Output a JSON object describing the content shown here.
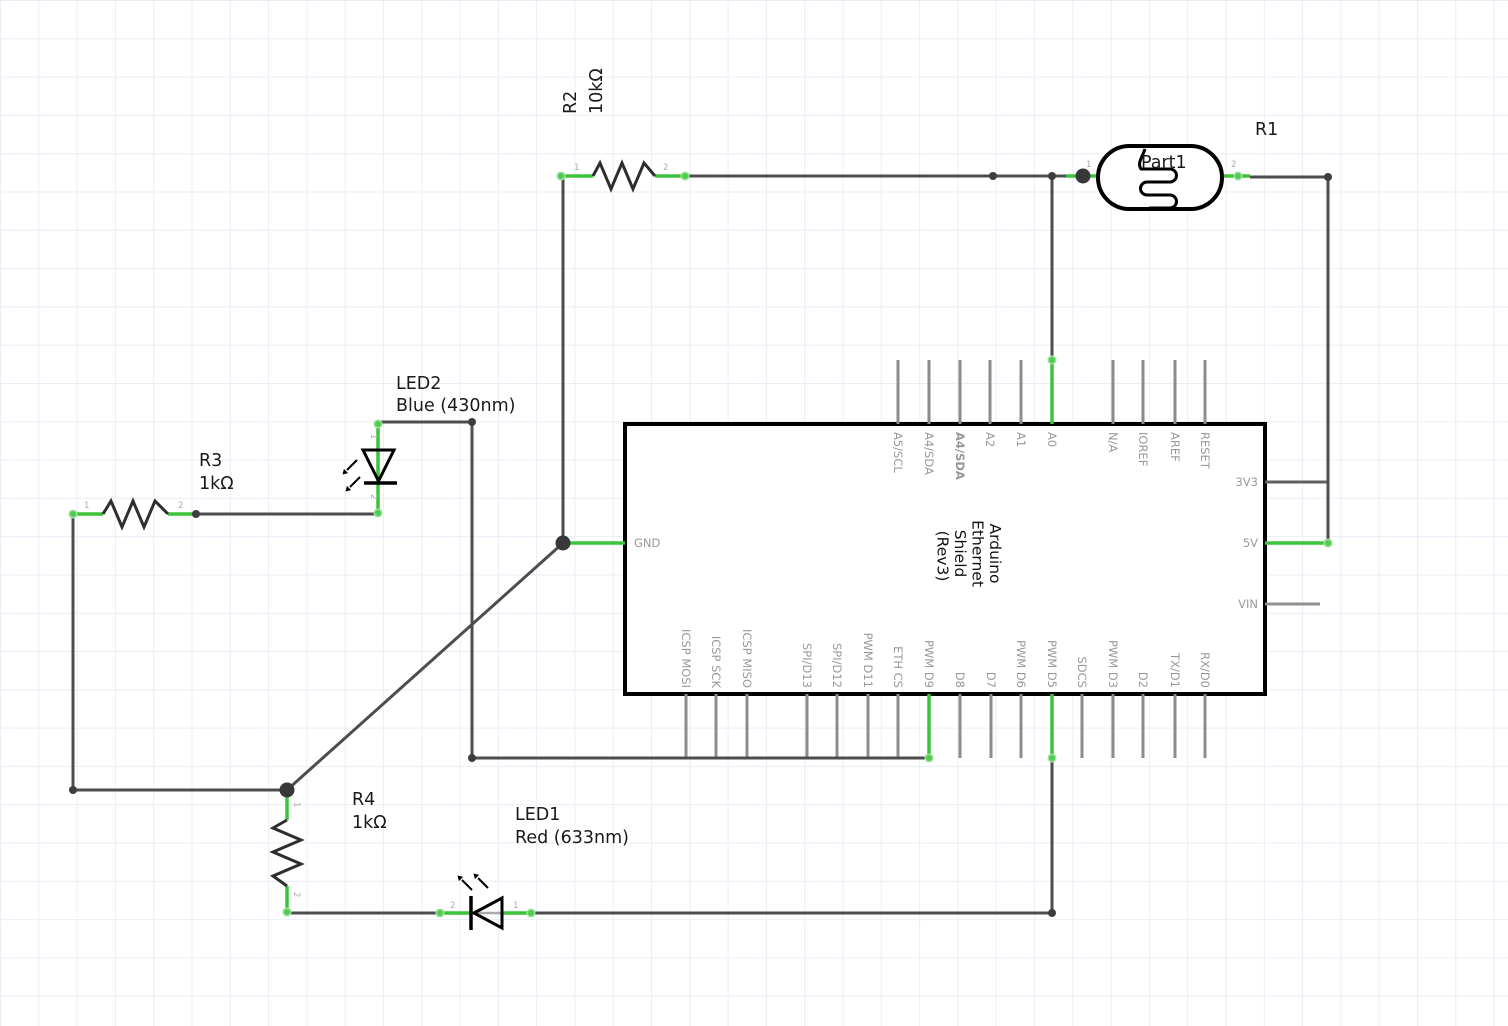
{
  "app": {
    "view": "schematic"
  },
  "colors": {
    "wire": "#4d4d4d",
    "connected_green": "#3bc43b",
    "pin_stub_gray": "#8c8c8c",
    "pin_label_gray": "#989898",
    "junction": "#383838",
    "chip_border": "#000000",
    "grid": "#e9eef6"
  },
  "components": {
    "r1": {
      "designator": "R1",
      "label": "Part1",
      "pins": [
        "1",
        "2"
      ]
    },
    "r2": {
      "designator": "R2",
      "value": "10kΩ",
      "pins": [
        "1",
        "2"
      ]
    },
    "r3": {
      "designator": "R3",
      "value": "1kΩ",
      "pins": [
        "1",
        "2"
      ]
    },
    "r4": {
      "designator": "R4",
      "value": "1kΩ",
      "pins": [
        "1",
        "2"
      ]
    },
    "led1": {
      "designator": "LED1",
      "value": "Red (633nm)",
      "pins": [
        "1",
        "2"
      ]
    },
    "led2": {
      "designator": "LED2",
      "value": "Blue (430nm)",
      "pins": [
        "1",
        "2"
      ]
    }
  },
  "chip": {
    "title_lines": [
      "Arduino",
      "Ethernet",
      "Shield",
      "(Rev3)"
    ],
    "top_pins": [
      "A5/SCL",
      "A4/SDA",
      "A4/SDA",
      "A2",
      "A1",
      "A0",
      "N/A",
      "IOREF",
      "AREF",
      "RESET"
    ],
    "bottom_pins": [
      "ICSP MOSI",
      "ICSP SCK",
      "ICSP MISO",
      "SPI/D13",
      "SPI/D12",
      "PWM D11",
      "ETH CS",
      "PWM D9",
      "D8",
      "D7",
      "PWM D6",
      "PWM D5",
      "SDCS",
      "PWM D3",
      "D2",
      "TX/D1",
      "RX/D0"
    ],
    "right_pins": [
      "3V3",
      "5V",
      "VIN"
    ],
    "left_pins": [
      "GND"
    ]
  }
}
